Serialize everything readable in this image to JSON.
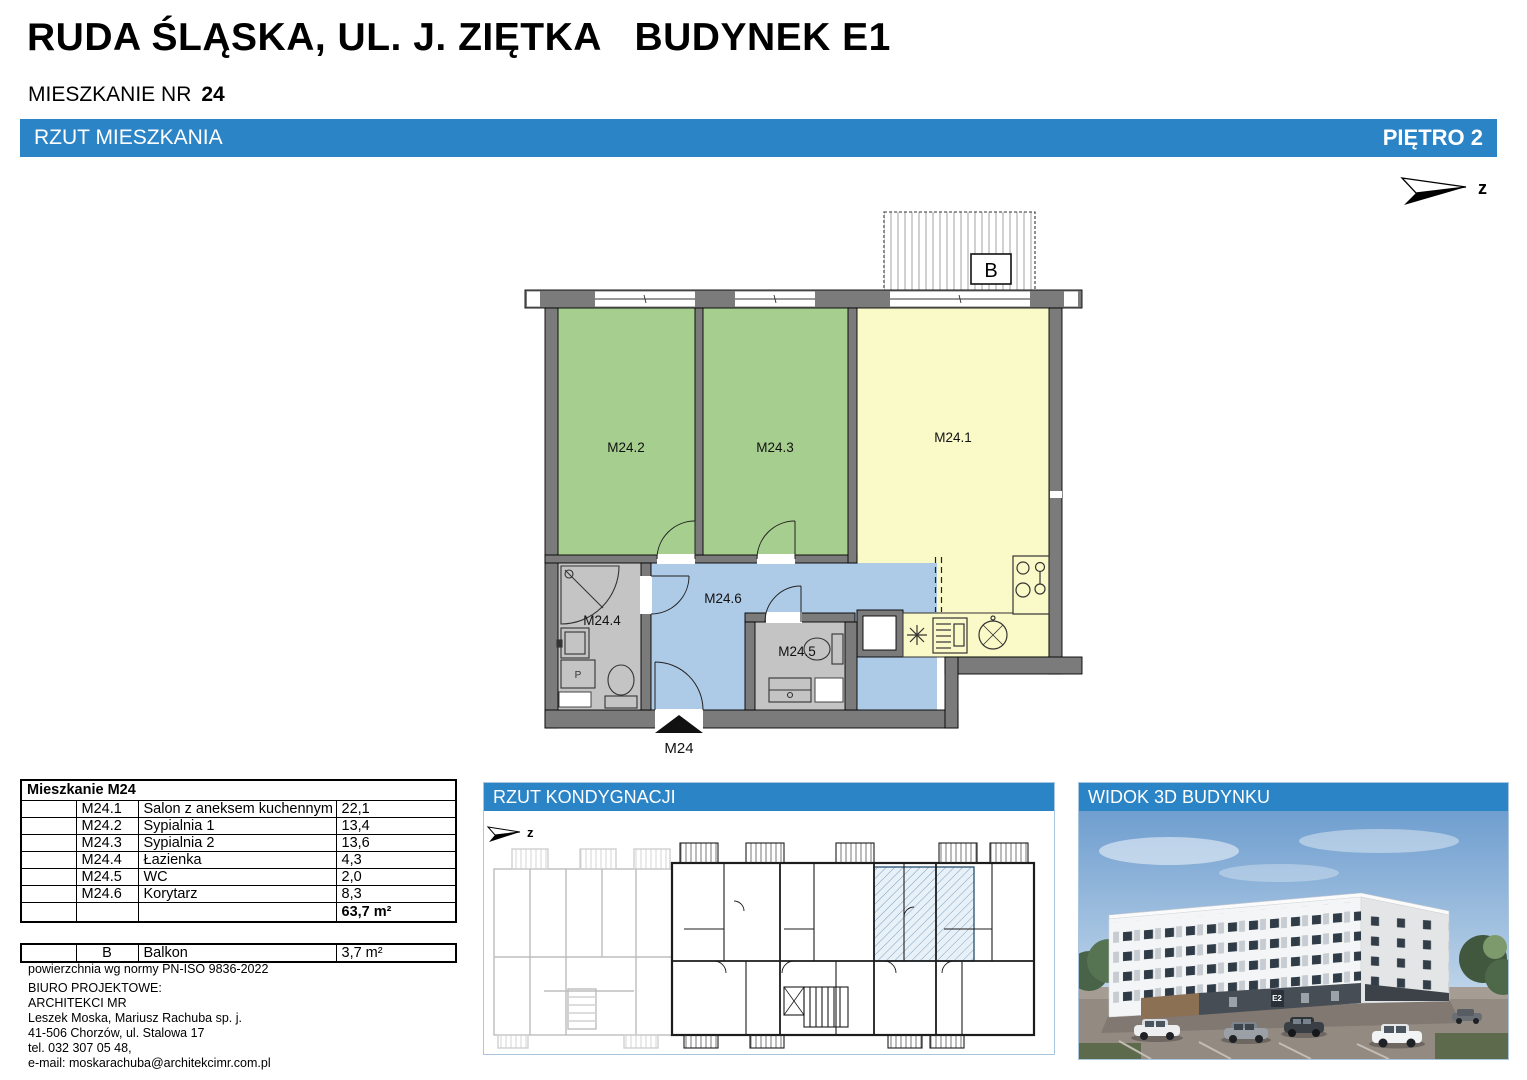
{
  "header": {
    "title": "RUDA ŚLĄSKA, UL. J. ZIĘTKA   BUDYNEK E1",
    "apartment_label": "MIESZKANIE NR",
    "apartment_number": "24"
  },
  "section_bars": {
    "plan": "RZUT MIESZKANIA",
    "floor": "PIĘTRO 2",
    "level_plan": "RZUT KONDYGNACJI",
    "view_3d": "WIDOK 3D BUDYNKU"
  },
  "compass_label": "z",
  "floor_plan": {
    "room_labels": {
      "r1": "M24.1",
      "r2": "M24.2",
      "r3": "M24.3",
      "r4": "M24.4",
      "r5": "M24.5",
      "r6": "M24.6"
    },
    "washer_symbol": "P",
    "balcony_label": "B",
    "entry_label": "M24"
  },
  "area_table": {
    "title": "Mieszkanie M24",
    "rows": [
      {
        "id": "M24.1",
        "name": "Salon z aneksem kuchennym",
        "area": "22,1"
      },
      {
        "id": "M24.2",
        "name": "Sypialnia 1",
        "area": "13,4"
      },
      {
        "id": "M24.3",
        "name": "Sypialnia 2",
        "area": "13,6"
      },
      {
        "id": "M24.4",
        "name": "Łazienka",
        "area": "4,3"
      },
      {
        "id": "M24.5",
        "name": "WC",
        "area": "2,0"
      },
      {
        "id": "M24.6",
        "name": "Korytarz",
        "area": "8,3"
      }
    ],
    "total": "63,7 m²"
  },
  "balcony_table": {
    "id": "B",
    "name": "Balkon",
    "area": "3,7 m²"
  },
  "area_note": "powierzchnia wg normy PN-ISO 9836-2022",
  "office_lines": [
    "BIURO PROJEKTOWE:",
    "ARCHITEKCI MR",
    "Leszek Moska, Mariusz Rachuba sp. j.",
    "41-506 Chorzów, ul. Stalowa 17",
    "tel. 032 307 05 48,",
    "e-mail: moskarachuba@architekcimr.com.pl"
  ],
  "building_label": "E2",
  "colors": {
    "accent_blue": "#2b84c6",
    "room_green": "#a6ce8e",
    "room_yellow": "#fafac8",
    "corridor_blue": "#adcae6",
    "wet_room_gray": "#c4c4c4",
    "wall_gray": "#7b7b7b"
  }
}
